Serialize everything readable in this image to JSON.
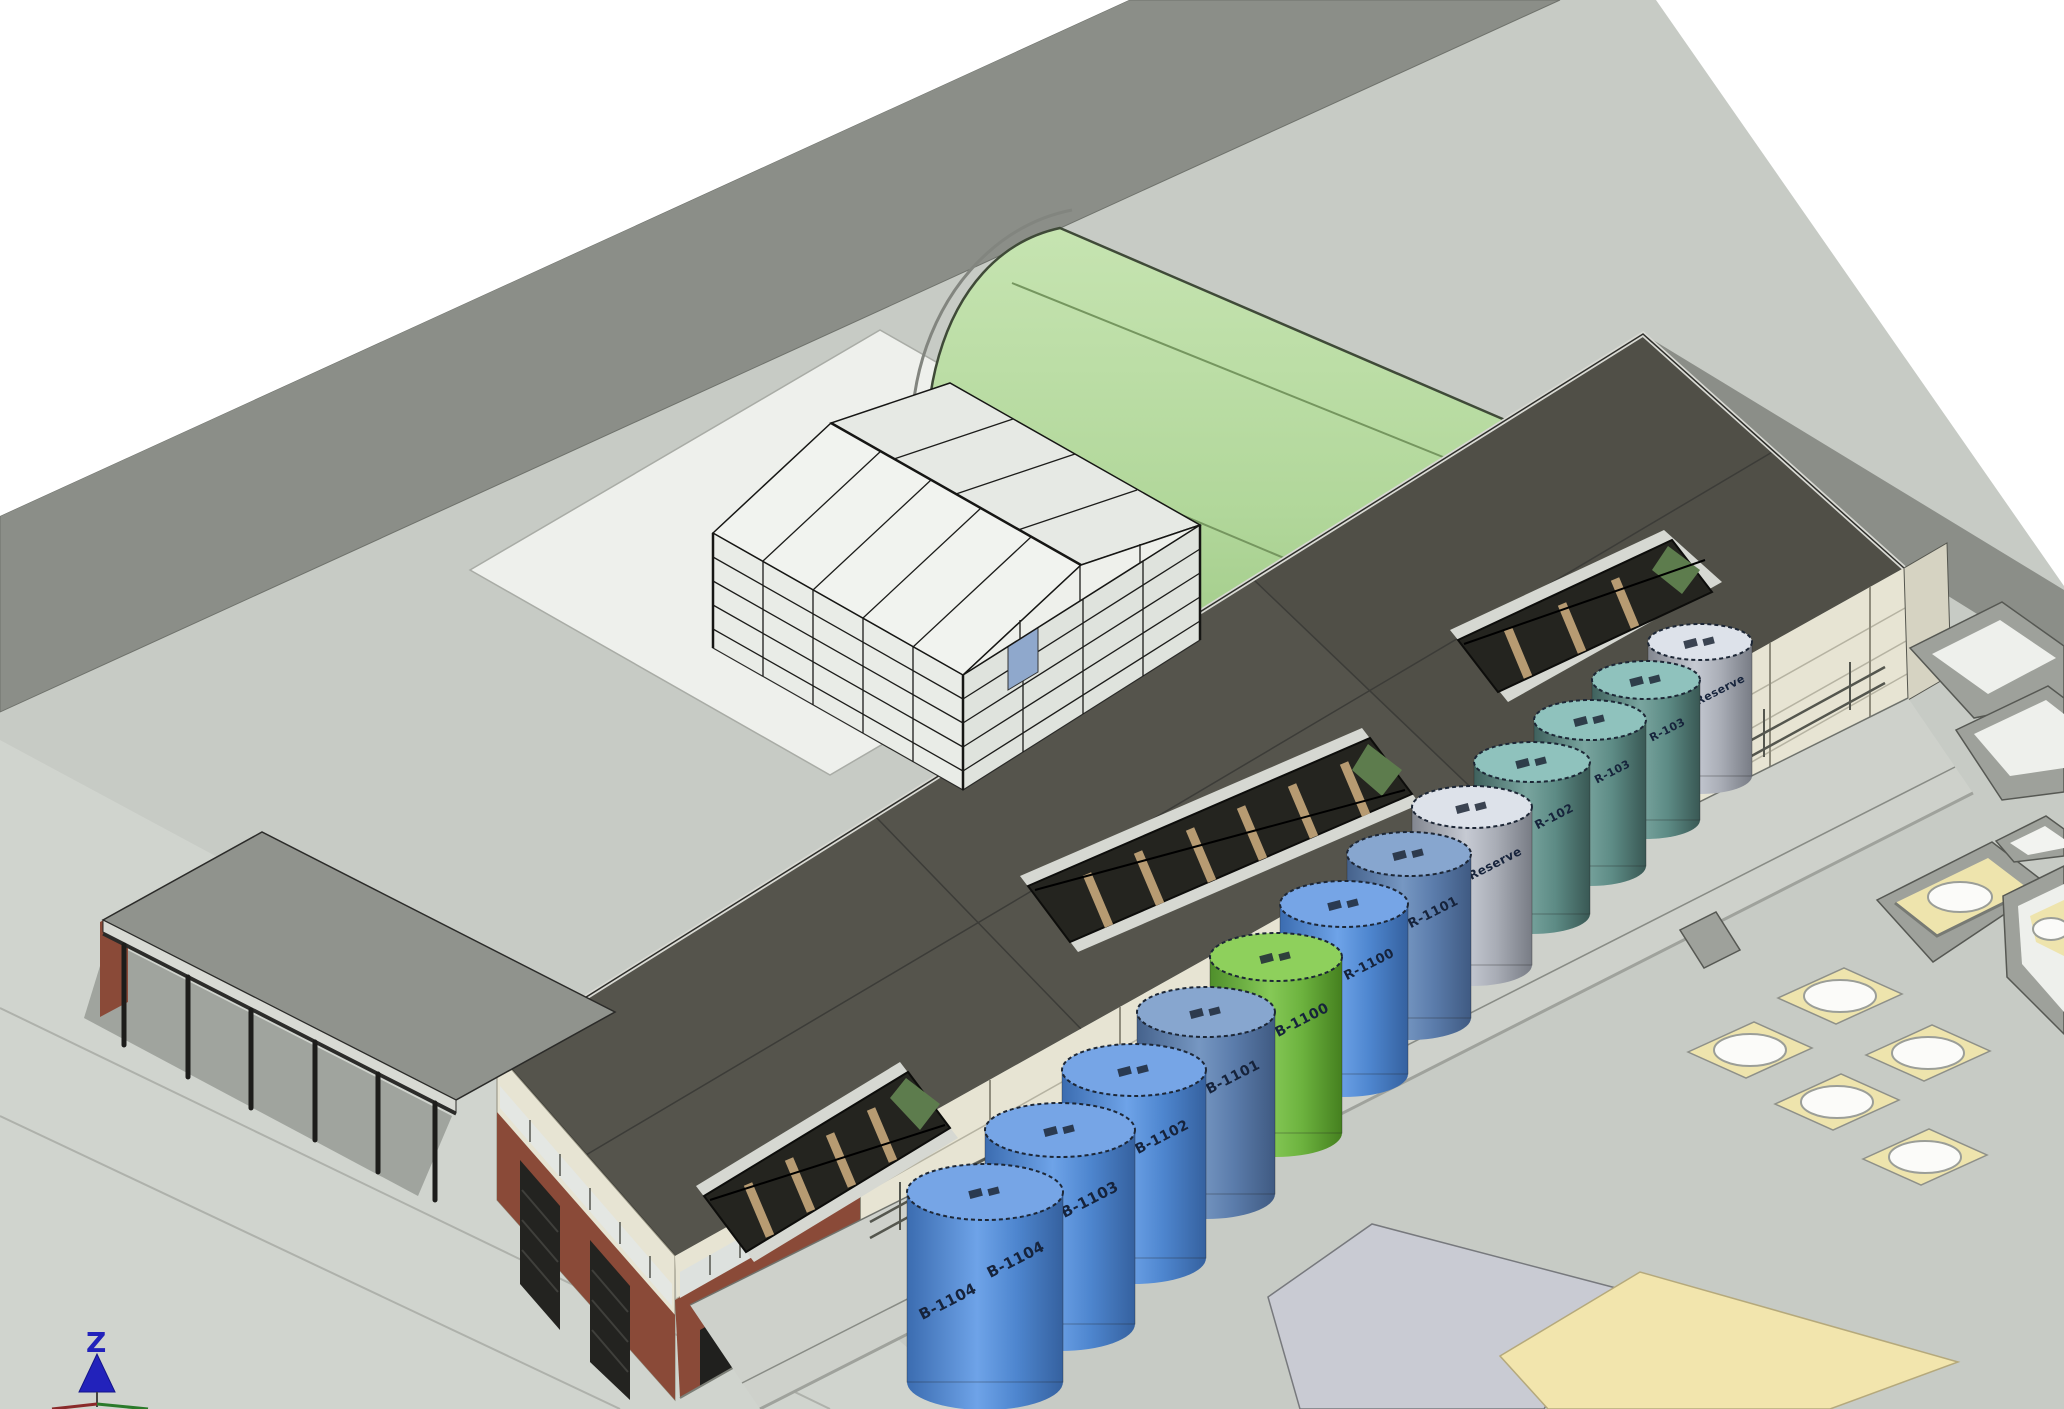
{
  "meta": {
    "view_type": "3D isometric BIM site model",
    "scene_description": "Industrial plant site with vaulted hall, greenhouse frame, process hall with roof skylights, tank farm, foundation pads and containment basins"
  },
  "axis_indicator": {
    "z_label": "Z"
  },
  "colors": {
    "white": "#ffffff",
    "platform": "#c7cbc5",
    "platform_light": "#d4d7d1",
    "road": "#8b8e88",
    "pad_concrete": "#eef0ec",
    "roof_dark": "#55544c",
    "wall_cream": "#e7e4d3",
    "brick": "#8a4a38",
    "canopy_roof": "#90938d",
    "unit_blue": "#8d99c0",
    "skylight_dark": "#24241f",
    "slat_tan": "#b79b72",
    "pad_yellow": "#eee4ad",
    "slab_gray": "#c9cbd3",
    "slab_yellow": "#f2e5ad",
    "basin_wall": "#9ea19b",
    "basin_floor": "#eef0ec",
    "tank_blue_top": "#76a5e6",
    "tank_blue_muted_top": "#87a6cf",
    "tank_green_top": "#8ed05c",
    "tank_gray_top": "#dde2ea",
    "tank_teal_top": "#8fc2bd",
    "label_ink": "#16233b",
    "axis_blue": "#2222bb"
  },
  "tanks": [
    {
      "label": "B-1104",
      "type": "blue"
    },
    {
      "label": "B-1103",
      "type": "blue"
    },
    {
      "label": "B-1102",
      "type": "blue"
    },
    {
      "label": "B-1101",
      "type": "blue"
    },
    {
      "label": "B-1100",
      "type": "green"
    },
    {
      "label": "R-1100",
      "type": "blue"
    },
    {
      "label": "R-1101",
      "type": "blue-muted"
    },
    {
      "label": "Reserve",
      "type": "gray"
    },
    {
      "label": "R-102",
      "type": "teal"
    },
    {
      "label": "R-103",
      "type": "teal"
    },
    {
      "label": "R-103",
      "type": "teal"
    },
    {
      "label": "Reserve",
      "type": "gray"
    }
  ],
  "site": {
    "tank_count": 12,
    "foundation_pad_count": 5,
    "skylight_count": 3,
    "vault_end_unit_count": 4
  }
}
